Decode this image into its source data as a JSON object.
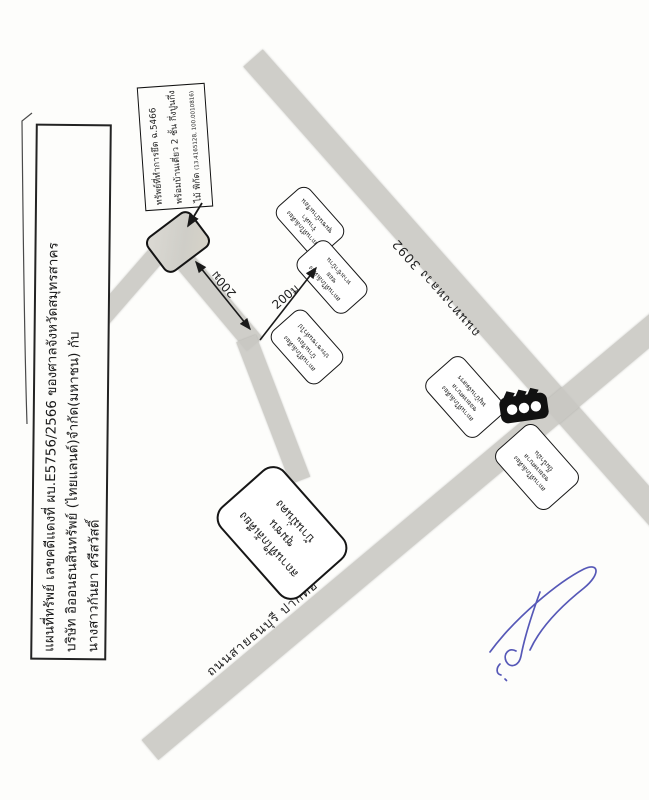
{
  "title_block": {
    "lines": [
      "แผนที่ทรัพย์ เลขคดีแดงที่ ผบ.E5756/2566 ของศาลจังหวัดสมุทรสาคร",
      "บริษัท อิออนธนสินทรัพย์ (ไทยแลนด์)จำกัด(มหาชน) กับ",
      "นางสาวกันยา ศรีสวัสดิ์"
    ]
  },
  "seized_property_note": {
    "line1": "ทรัพย์ที่ทำการยึด ฉ.5466",
    "line2": "พร้อมบ้านเดี่ยว 2 ชั้น กึ่งปูนกึ่ง",
    "line3_prefix": "ไม้ พิกัด ",
    "coords": "(13.4165128, 100.0010816)"
  },
  "roads": {
    "highway_label": "ถนนทางหลวง 3092",
    "thonburi_label": "ถนนสายธนบุรี ปากท่อ"
  },
  "distance_labels": {
    "access": "200ม",
    "connector": "200ม"
  },
  "landmark_boxes": [
    {
      "lines": [
        "สถานที่ใกล้เคียง",
        "ร้านค้า",
        "ชุมชนบ้านเรือน"
      ]
    },
    {
      "lines": [
        "สถานที่ใกล้เคียง",
        "ซอย",
        "ทางเข้าบ้าน"
      ]
    },
    {
      "lines": [
        "สถานที่ใกล้เคียง",
        "บ้านเรือน",
        "ประชาชนทั่วไป"
      ]
    },
    {
      "lines": [
        "สถานที่ใกล้เคียง",
        "ซอยเทศบาล",
        "หมู่บ้านจัดสรร"
      ]
    },
    {
      "lines": [
        "สถานที่ใกล้เคียง",
        "ซอยเทศบาล",
        "ปั๊มน้ำมัน"
      ]
    },
    {
      "lines": [
        "สถานที่ใกล้เคียง",
        "ชุมชน",
        "บ้านมั่นคง"
      ]
    }
  ],
  "icons": {
    "traffic_light": "traffic-light",
    "pointer_arrow": "arrow-to-property",
    "double_arrow": "distance-double-arrow",
    "northeast_arrow": "distance-arrow"
  },
  "colors": {
    "paper": "#fdfdfb",
    "ink": "#1c1c1c",
    "road_fill": "#c9c8c3",
    "signature_ink": "#4447b0"
  }
}
